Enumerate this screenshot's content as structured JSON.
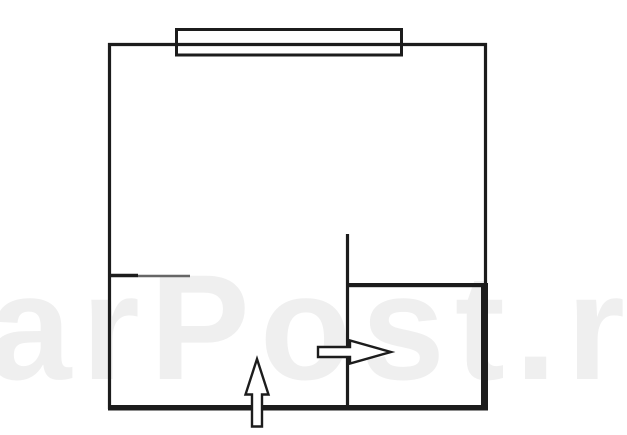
{
  "watermark": {
    "text": "arPost.r"
  },
  "colors": {
    "line": "#1c1c1c",
    "line-secondary": "#666666",
    "watermark": "#efefef",
    "background": "#ffffff"
  },
  "plan": {
    "type": "floor-plan-line-drawing",
    "icons": {
      "window": "window-double-line-icon",
      "entrance_bottom": "entrance-arrow-up-icon",
      "entrance_inner": "entrance-arrow-right-icon"
    }
  }
}
